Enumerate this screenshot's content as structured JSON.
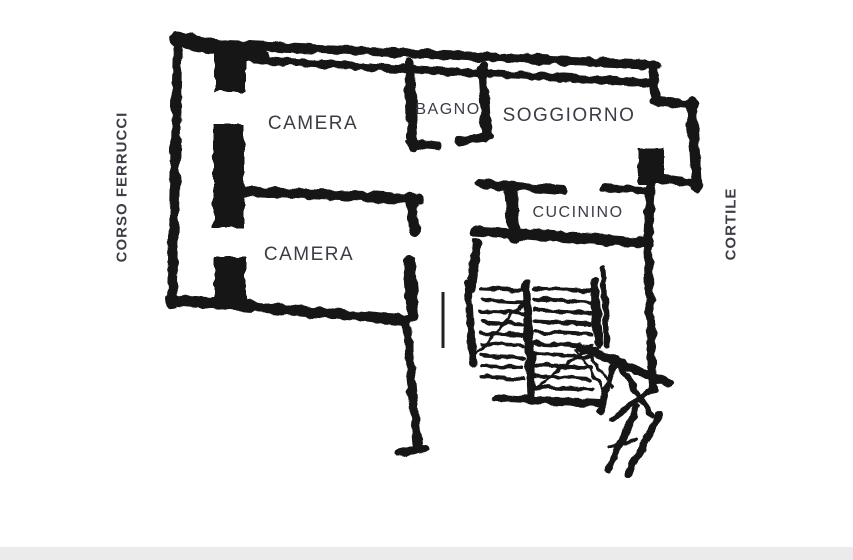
{
  "plan": {
    "type": "floor-plan",
    "room_labels": {
      "camera1": "CAMERA",
      "bagno": "BAGNO",
      "soggiorno": "SOGGIORNO",
      "cucinino": "CUCININO",
      "camera2": "CAMERA"
    },
    "street_left": "CORSO FERRUCCI",
    "street_right": "CORTILE",
    "features": [
      "staircase",
      "diagonal-shaft"
    ],
    "colors": {
      "wall": "#161616",
      "label_text": "#3c3c46",
      "background": "#ffffff"
    }
  }
}
